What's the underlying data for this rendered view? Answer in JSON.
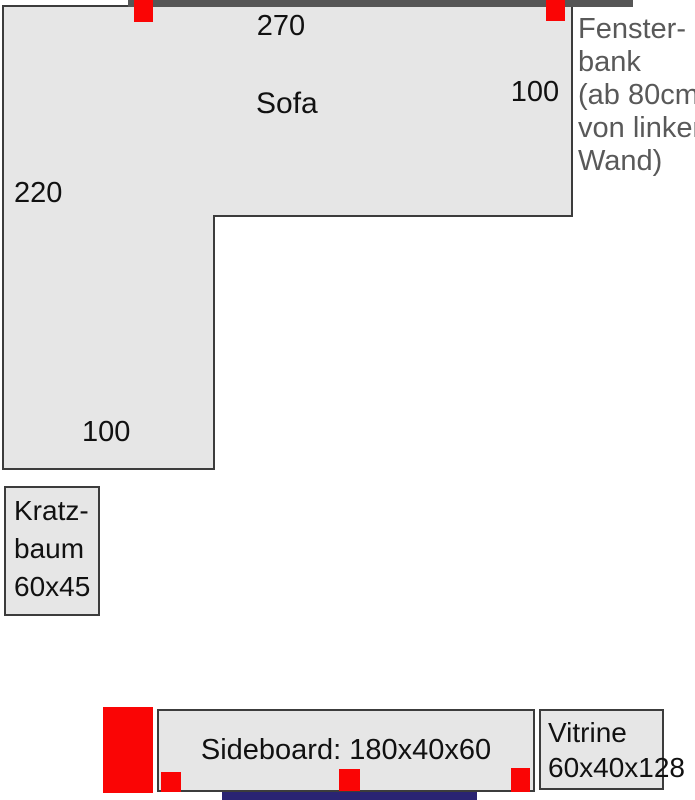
{
  "palette": {
    "sofa_fill": "#e6e6e6",
    "outline": "#3c3c3c",
    "wall_gray": "#565656",
    "marker_red": "#fa0505",
    "wall_navy": "#2a2472",
    "note_gray": "#595959",
    "label_black": "#111111"
  },
  "sofa": {
    "label": "Sofa",
    "dim_top": "270",
    "dim_right": "100",
    "dim_left": "220",
    "dim_bottom": "100"
  },
  "fensterbank": {
    "lines": [
      "Fenster-",
      "bank",
      "(ab 80cm",
      "von linker",
      "Wand)"
    ]
  },
  "kratzbaum": {
    "lines": [
      "Kratz-",
      "baum",
      "60x45"
    ]
  },
  "sideboard": {
    "label": "Sideboard: 180x40x60"
  },
  "vitrine": {
    "lines": [
      "Vitrine",
      "60x40x128"
    ]
  }
}
